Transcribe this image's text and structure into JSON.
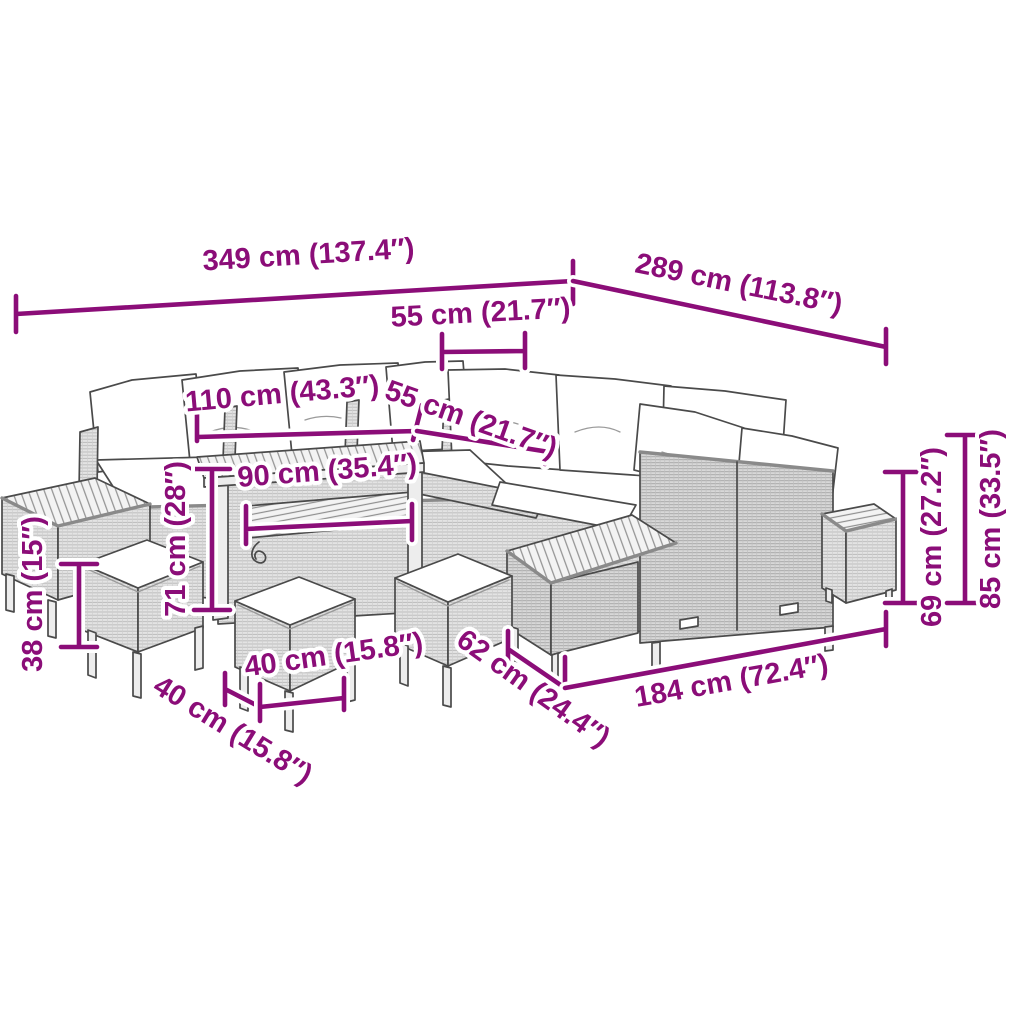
{
  "page": {
    "background_color": "#ffffff"
  },
  "diagram": {
    "kind": "product dimension diagram",
    "subject": "poly rattan garden lounge set with cushions, dining table, side tables and stools",
    "accent_color": "#8B0D78",
    "line_art_color": "#4a4a4a",
    "dimensions": {
      "overall_width": "349 cm (137.4″)",
      "overall_depth": "289 cm (113.8″)",
      "backrest_cushion_width": "55 cm (21.7″)",
      "table_length": "110 cm (43.3″)",
      "seat_width": "55 cm (21.7″)",
      "table_shelf_length": "90 cm (35.4″)",
      "table_height": "71 cm (28″)",
      "stool_height": "38 cm (15″)",
      "stool_depth": "40 cm (15.8″)",
      "stool_width": "40 cm (15.8″)",
      "sofa_depth": "62 cm (24.4″)",
      "sofa_length": "184 cm (72.4″)",
      "backrest_height": "69 cm (27.2″)",
      "overall_height": "85 cm (33.5″)"
    }
  }
}
